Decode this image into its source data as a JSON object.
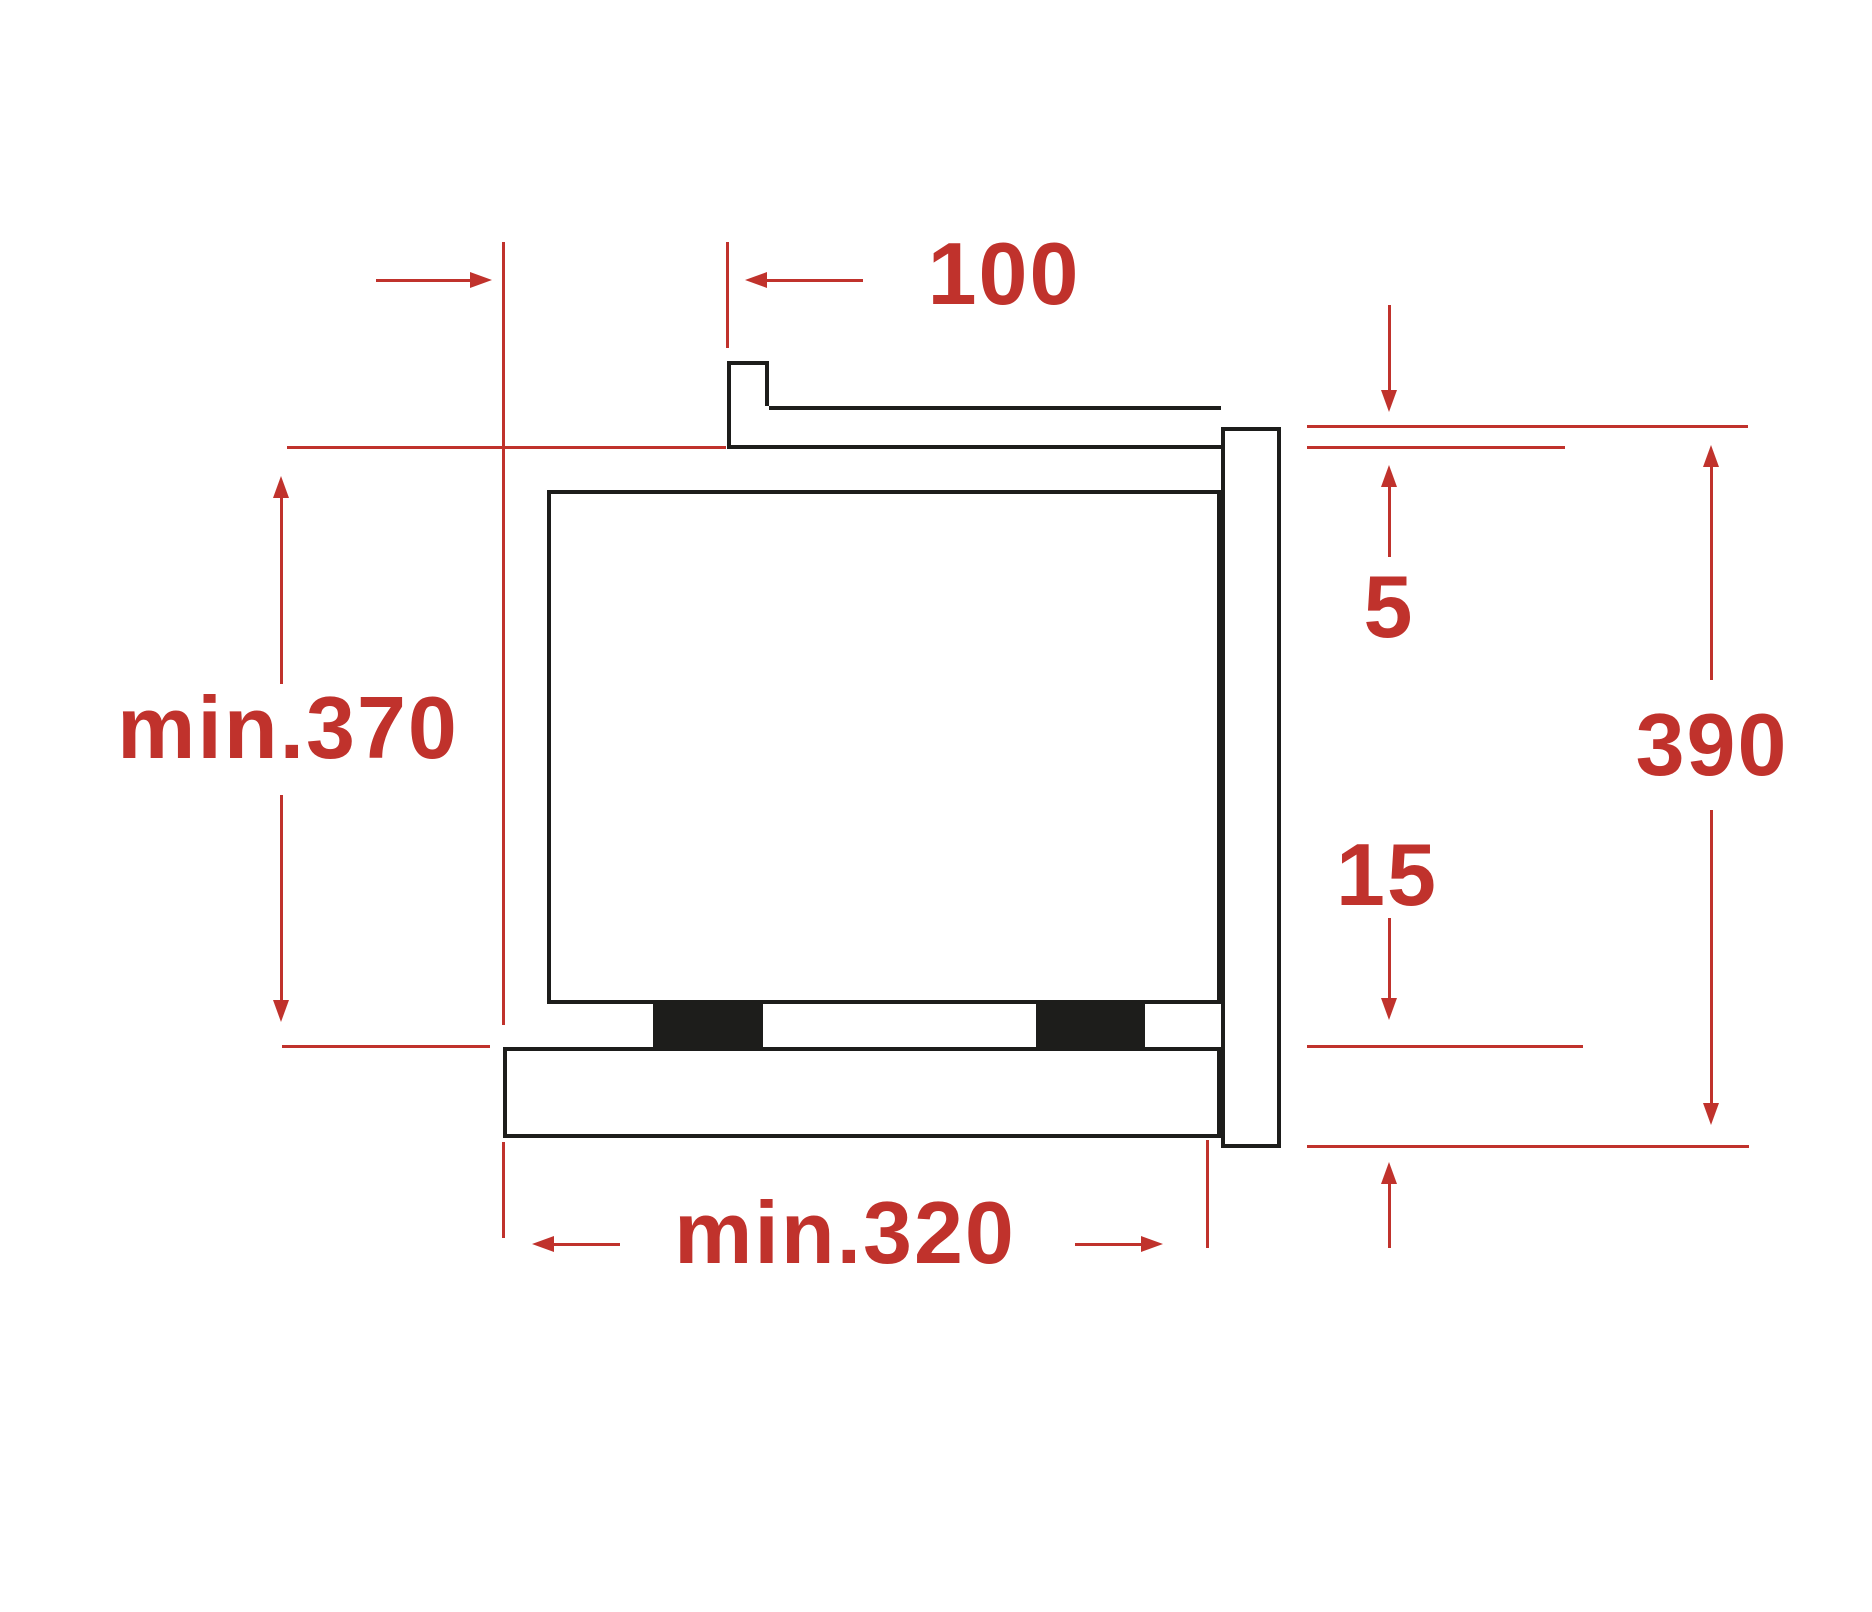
{
  "diagram": {
    "colors": {
      "dimension_red": "#c0322c",
      "line_black": "#1d1d1b",
      "background": "#ffffff"
    },
    "dimensions": {
      "rear_offset": "100",
      "top_gap": "5",
      "front_frame_height": "390",
      "bottom_gap": "15",
      "niche_height": "min.370",
      "niche_depth": "min.320"
    }
  }
}
